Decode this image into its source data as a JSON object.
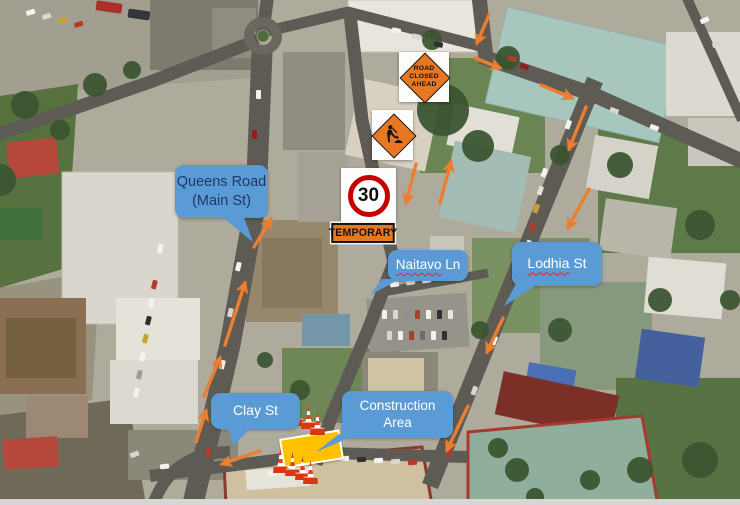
{
  "callouts": {
    "queens_road": {
      "line1": "Queens Road",
      "line2": "(Main St)"
    },
    "naitavo_ln": {
      "word": "Naitavo",
      "suffix": " Ln"
    },
    "lodhia_st": {
      "word": "Lodhia",
      "suffix": " St"
    },
    "clay_st": {
      "label": "Clay St"
    },
    "construction_area": {
      "line1": "Construction",
      "line2": "Area"
    }
  },
  "signs": {
    "road_closed_ahead": {
      "line1": "ROAD",
      "line2": "CLOSED",
      "line3": "AHEAD",
      "icon": "orange-diamond-warning"
    },
    "roadworks": {
      "icon": "worker-digging-diamond"
    },
    "speed_limit": {
      "value": "30",
      "icon": "red-circle-speed-sign"
    },
    "temporary": {
      "label": "TEMPORARY"
    }
  },
  "markers": {
    "construction_zone": {
      "icon": "work-zone-rectangle",
      "color": "#FFC000"
    },
    "traffic_cones": {
      "icon": "traffic-cone",
      "count_top": 3,
      "count_bottom": 4
    },
    "flow_arrows": {
      "icon": "traffic-flow-arrow",
      "color": "#ED7D31",
      "count": 14
    }
  },
  "colors": {
    "callout_fill": "#5B9BD5",
    "callout_text_queens": "#1F3864",
    "callout_text_light": "#FFFFFF",
    "sign_orange": "#E87722",
    "speed_ring_red": "#C40000",
    "spellcheck_underline": "#FF1A1A"
  }
}
